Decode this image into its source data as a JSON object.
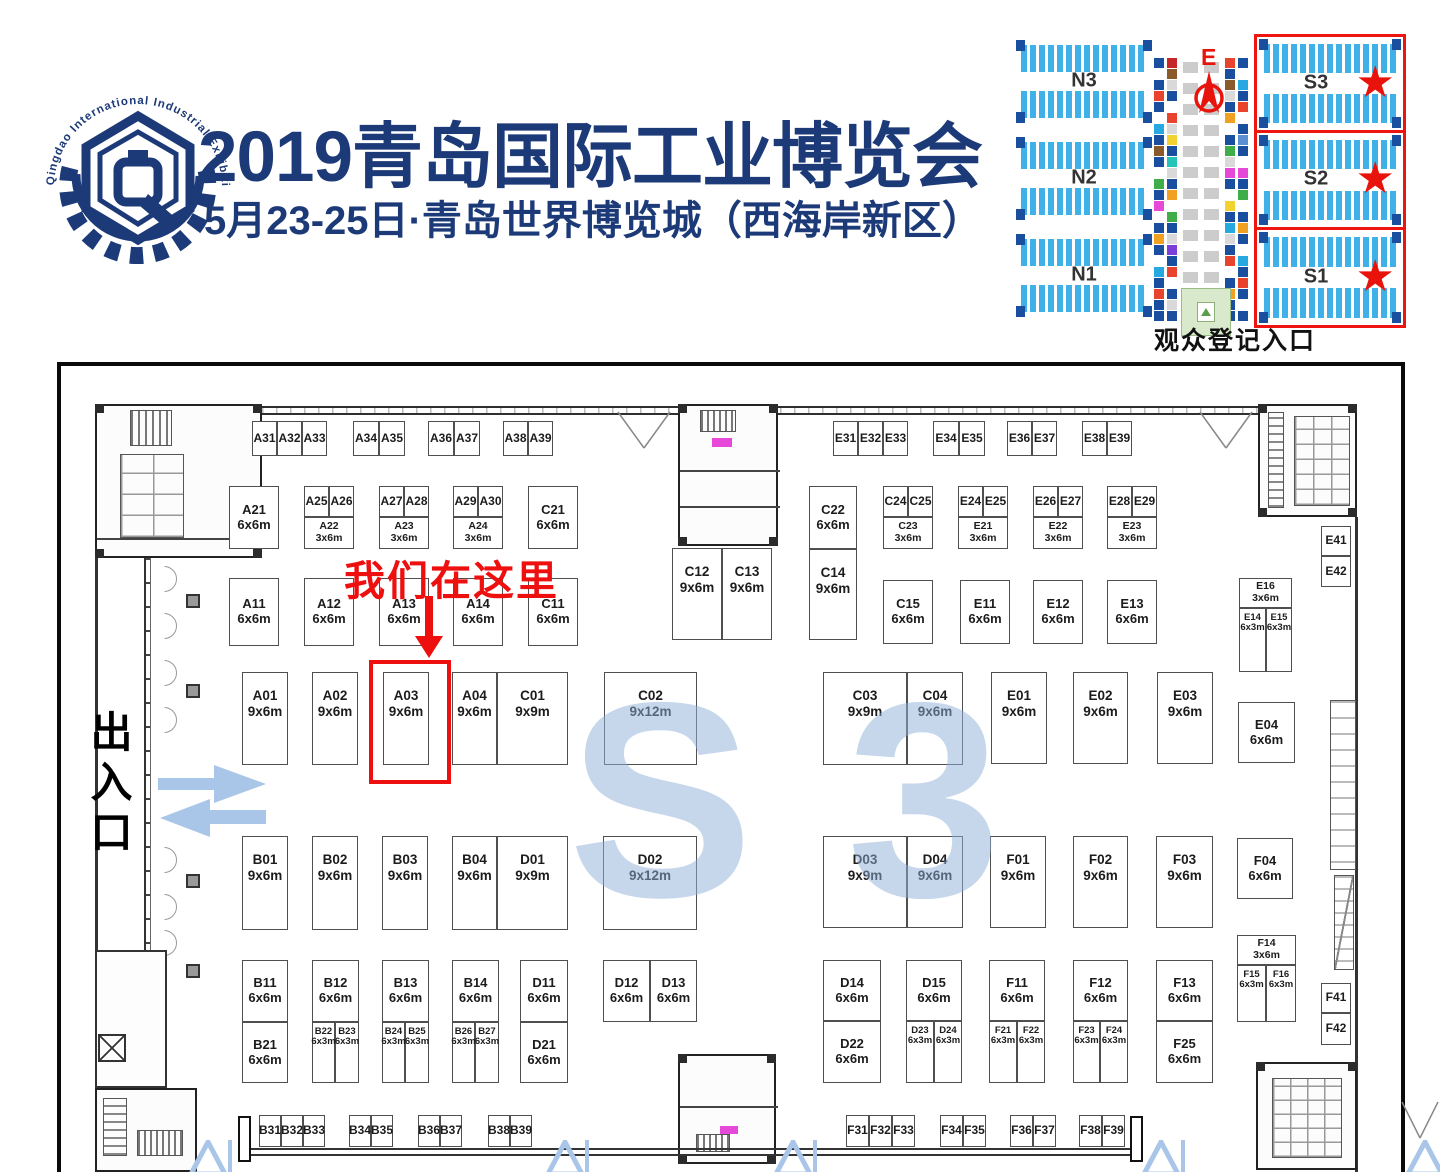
{
  "header": {
    "logo_ring_text": "Qingdao International Industrial Exhibition",
    "title": "2019青岛国际工业博览会",
    "subtitle": "5月23-25日·青岛世界博览城（西海岸新区）"
  },
  "colors": {
    "navy": "#1d3a78",
    "annotation_red": "#ee0f0f",
    "hall_blue": "#3fb0e8",
    "hall_navy": "#1a4fa0",
    "watermark_blue": "#8fb0da",
    "arrow_blue": "#a9c6e8",
    "entrance_green": "#d9e9cc"
  },
  "minimap": {
    "caption": "观众登记入口",
    "compass_label": "E",
    "star_icon": "★",
    "north_halls": [
      {
        "label": "N3",
        "top": 18
      },
      {
        "label": "N2",
        "top": 115
      },
      {
        "label": "N1",
        "top": 212
      }
    ],
    "south_halls": [
      {
        "label": "S3",
        "top": 12,
        "h": 93
      },
      {
        "label": "S2",
        "top": 108,
        "h": 94
      },
      {
        "label": "S1",
        "top": 205,
        "h": 95
      }
    ],
    "corridor_strips": [
      {
        "x": 149,
        "colors": [
          "#1a4fa0",
          "#ffffff",
          "#1a4fa0",
          "#e8432d",
          "#1a4fa0",
          "#ffffff",
          "#26a9e0",
          "#1a4fa0",
          "#8a5a2b",
          "#1a4fa0",
          "#ffffff",
          "#3fae49",
          "#1a4fa0",
          "#e649d8",
          "#ffffff",
          "#1a4fa0",
          "#f0a122",
          "#1a4fa0",
          "#ffffff",
          "#26a9e0",
          "#1a4fa0",
          "#e8432d",
          "#1a4fa0",
          "#1a4fa0"
        ]
      },
      {
        "x": 162,
        "colors": [
          "#c62828",
          "#8a5a2b",
          "#d9d9d9",
          "#1a4fa0",
          "#ffffff",
          "#e8432d",
          "#d9d9d9",
          "#f2d22e",
          "#1a4fa0",
          "#26c4b8",
          "#d9d9d9",
          "#1a4fa0",
          "#f0a122",
          "#ffffff",
          "#3fae49",
          "#1a4fa0",
          "#d9d9d9",
          "#7a3fd8",
          "#1a4fa0",
          "#e8432d",
          "#ffffff",
          "#1a4fa0",
          "#d9d9d9",
          "#1a4fa0"
        ]
      },
      {
        "x": 220,
        "colors": [
          "#e8432d",
          "#1a4fa0",
          "#8a5a2b",
          "#d9d9d9",
          "#1a4fa0",
          "#f0a122",
          "#ffffff",
          "#1a4fa0",
          "#3fae49",
          "#d9d9d9",
          "#e649d8",
          "#1a4fa0",
          "#ffffff",
          "#f2d22e",
          "#1a4fa0",
          "#26a9e0",
          "#d9d9d9",
          "#1a4fa0",
          "#e8432d",
          "#ffffff",
          "#1a4fa0",
          "#f0a122",
          "#1a4fa0",
          "#1a4fa0"
        ]
      },
      {
        "x": 233,
        "colors": [
          "#1a4fa0",
          "#ffffff",
          "#26a9e0",
          "#1a4fa0",
          "#e8432d",
          "#ffffff",
          "#1a4fa0",
          "#5a8fd4",
          "#1a4fa0",
          "#ffffff",
          "#e649d8",
          "#1a4fa0",
          "#3fae49",
          "#ffffff",
          "#1a4fa0",
          "#f0a122",
          "#1a4fa0",
          "#ffffff",
          "#26a9e0",
          "#1a4fa0",
          "#e8432d",
          "#1a4fa0",
          "#ffffff",
          "#1a4fa0"
        ]
      }
    ]
  },
  "floorplan": {
    "watermark": "S 3",
    "exit_label": "出入口",
    "annotation": {
      "text": "我们在这里",
      "target_booth": "A03"
    },
    "booths": [
      {
        "id": "A31",
        "x": 252,
        "y": 421,
        "w": 25,
        "h": 35
      },
      {
        "id": "A32",
        "x": 277,
        "y": 421,
        "w": 25,
        "h": 35
      },
      {
        "id": "A33",
        "x": 302,
        "y": 421,
        "w": 25,
        "h": 35
      },
      {
        "id": "A34",
        "x": 353,
        "y": 421,
        "w": 26,
        "h": 35
      },
      {
        "id": "A35",
        "x": 379,
        "y": 421,
        "w": 26,
        "h": 35
      },
      {
        "id": "A36",
        "x": 428,
        "y": 421,
        "w": 26,
        "h": 35
      },
      {
        "id": "A37",
        "x": 454,
        "y": 421,
        "w": 26,
        "h": 35
      },
      {
        "id": "A38",
        "x": 503,
        "y": 421,
        "w": 25,
        "h": 35
      },
      {
        "id": "A39",
        "x": 528,
        "y": 421,
        "w": 25,
        "h": 35
      },
      {
        "id": "E31",
        "x": 833,
        "y": 421,
        "w": 25,
        "h": 35
      },
      {
        "id": "E32",
        "x": 858,
        "y": 421,
        "w": 25,
        "h": 35
      },
      {
        "id": "E33",
        "x": 883,
        "y": 421,
        "w": 25,
        "h": 35
      },
      {
        "id": "E34",
        "x": 933,
        "y": 421,
        "w": 26,
        "h": 35
      },
      {
        "id": "E35",
        "x": 959,
        "y": 421,
        "w": 26,
        "h": 35
      },
      {
        "id": "E36",
        "x": 1007,
        "y": 421,
        "w": 25,
        "h": 35
      },
      {
        "id": "E37",
        "x": 1032,
        "y": 421,
        "w": 25,
        "h": 35
      },
      {
        "id": "E38",
        "x": 1082,
        "y": 421,
        "w": 25,
        "h": 35
      },
      {
        "id": "E39",
        "x": 1107,
        "y": 421,
        "w": 25,
        "h": 35
      },
      {
        "id": "A21",
        "size": "6x6m",
        "x": 229,
        "y": 486,
        "w": 50,
        "h": 63
      },
      {
        "id": "A25",
        "x": 304,
        "y": 486,
        "w": 25,
        "h": 31
      },
      {
        "id": "A26",
        "x": 329,
        "y": 486,
        "w": 25,
        "h": 31
      },
      {
        "id": "A22",
        "size": "3x6m",
        "x": 304,
        "y": 517,
        "w": 50,
        "h": 32
      },
      {
        "id": "A27",
        "x": 379,
        "y": 486,
        "w": 25,
        "h": 31
      },
      {
        "id": "A28",
        "x": 404,
        "y": 486,
        "w": 25,
        "h": 31
      },
      {
        "id": "A23",
        "size": "3x6m",
        "x": 379,
        "y": 517,
        "w": 50,
        "h": 32
      },
      {
        "id": "A29",
        "x": 453,
        "y": 486,
        "w": 25,
        "h": 31
      },
      {
        "id": "A30",
        "x": 478,
        "y": 486,
        "w": 25,
        "h": 31
      },
      {
        "id": "A24",
        "size": "3x6m",
        "x": 453,
        "y": 517,
        "w": 50,
        "h": 32
      },
      {
        "id": "C21",
        "size": "6x6m",
        "x": 528,
        "y": 486,
        "w": 50,
        "h": 63
      },
      {
        "id": "C22",
        "size": "6x6m",
        "x": 809,
        "y": 486,
        "w": 48,
        "h": 63
      },
      {
        "id": "C24",
        "x": 883,
        "y": 486,
        "w": 25,
        "h": 31
      },
      {
        "id": "C25",
        "x": 908,
        "y": 486,
        "w": 25,
        "h": 31
      },
      {
        "id": "C23",
        "size": "3x6m",
        "x": 883,
        "y": 517,
        "w": 50,
        "h": 32
      },
      {
        "id": "E24",
        "x": 958,
        "y": 486,
        "w": 25,
        "h": 31
      },
      {
        "id": "E25",
        "x": 983,
        "y": 486,
        "w": 25,
        "h": 31
      },
      {
        "id": "E21",
        "size": "3x6m",
        "x": 958,
        "y": 517,
        "w": 50,
        "h": 32
      },
      {
        "id": "E26",
        "x": 1033,
        "y": 486,
        "w": 25,
        "h": 31
      },
      {
        "id": "E27",
        "x": 1058,
        "y": 486,
        "w": 25,
        "h": 31
      },
      {
        "id": "E22",
        "size": "3x6m",
        "x": 1033,
        "y": 517,
        "w": 50,
        "h": 32
      },
      {
        "id": "E28",
        "x": 1107,
        "y": 486,
        "w": 25,
        "h": 31
      },
      {
        "id": "E29",
        "x": 1132,
        "y": 486,
        "w": 25,
        "h": 31
      },
      {
        "id": "E23",
        "size": "3x6m",
        "x": 1107,
        "y": 517,
        "w": 50,
        "h": 32
      },
      {
        "id": "C12",
        "size": "9x6m",
        "x": 672,
        "y": 548,
        "w": 50,
        "h": 92
      },
      {
        "id": "C13",
        "size": "9x6m",
        "x": 722,
        "y": 548,
        "w": 50,
        "h": 92
      },
      {
        "id": "C14",
        "size": "9x6m",
        "x": 809,
        "y": 549,
        "w": 48,
        "h": 91
      },
      {
        "id": "A11",
        "size": "6x6m",
        "x": 229,
        "y": 578,
        "w": 50,
        "h": 68
      },
      {
        "id": "A12",
        "size": "6x6m",
        "x": 304,
        "y": 578,
        "w": 50,
        "h": 68
      },
      {
        "id": "A13",
        "size": "6x6m",
        "x": 379,
        "y": 578,
        "w": 50,
        "h": 68
      },
      {
        "id": "A14",
        "size": "6x6m",
        "x": 453,
        "y": 578,
        "w": 50,
        "h": 68
      },
      {
        "id": "C11",
        "size": "6x6m",
        "x": 528,
        "y": 578,
        "w": 50,
        "h": 68
      },
      {
        "id": "C15",
        "size": "6x6m",
        "x": 883,
        "y": 580,
        "w": 50,
        "h": 64
      },
      {
        "id": "E11",
        "size": "6x6m",
        "x": 960,
        "y": 580,
        "w": 50,
        "h": 64
      },
      {
        "id": "E12",
        "size": "6x6m",
        "x": 1033,
        "y": 580,
        "w": 50,
        "h": 64
      },
      {
        "id": "E13",
        "size": "6x6m",
        "x": 1107,
        "y": 580,
        "w": 50,
        "h": 64
      },
      {
        "id": "E41",
        "x": 1321,
        "y": 526,
        "w": 30,
        "h": 30
      },
      {
        "id": "E42",
        "x": 1321,
        "y": 556,
        "w": 30,
        "h": 31
      },
      {
        "id": "E16",
        "size": "3x6m",
        "x": 1239,
        "y": 578,
        "w": 53,
        "h": 30
      },
      {
        "id": "E14",
        "size": "6x3m",
        "x": 1239,
        "y": 608,
        "w": 27,
        "h": 64
      },
      {
        "id": "E15",
        "size": "6x3m",
        "x": 1266,
        "y": 608,
        "w": 26,
        "h": 64
      },
      {
        "id": "E04",
        "size": "6x6m",
        "x": 1238,
        "y": 702,
        "w": 57,
        "h": 61
      },
      {
        "id": "A01",
        "size": "9x6m",
        "x": 242,
        "y": 672,
        "w": 46,
        "h": 93
      },
      {
        "id": "A02",
        "size": "9x6m",
        "x": 312,
        "y": 672,
        "w": 46,
        "h": 93
      },
      {
        "id": "A03",
        "size": "9x6m",
        "x": 383,
        "y": 672,
        "w": 46,
        "h": 93
      },
      {
        "id": "A04",
        "size": "9x6m",
        "x": 452,
        "y": 672,
        "w": 45,
        "h": 93
      },
      {
        "id": "C01",
        "size": "9x9m",
        "x": 497,
        "y": 672,
        "w": 71,
        "h": 93
      },
      {
        "id": "C02",
        "size": "9x12m",
        "x": 604,
        "y": 672,
        "w": 93,
        "h": 93
      },
      {
        "id": "C03",
        "size": "9x9m",
        "x": 823,
        "y": 672,
        "w": 84,
        "h": 93
      },
      {
        "id": "C04",
        "size": "9x6m",
        "x": 907,
        "y": 672,
        "w": 56,
        "h": 93
      },
      {
        "id": "E01",
        "size": "9x6m",
        "x": 991,
        "y": 672,
        "w": 56,
        "h": 92
      },
      {
        "id": "E02",
        "size": "9x6m",
        "x": 1073,
        "y": 672,
        "w": 55,
        "h": 92
      },
      {
        "id": "E03",
        "size": "9x6m",
        "x": 1157,
        "y": 672,
        "w": 56,
        "h": 92
      },
      {
        "id": "B01",
        "size": "9x6m",
        "x": 242,
        "y": 836,
        "w": 46,
        "h": 94
      },
      {
        "id": "B02",
        "size": "9x6m",
        "x": 312,
        "y": 836,
        "w": 46,
        "h": 94
      },
      {
        "id": "B03",
        "size": "9x6m",
        "x": 382,
        "y": 836,
        "w": 46,
        "h": 94
      },
      {
        "id": "B04",
        "size": "9x6m",
        "x": 452,
        "y": 836,
        "w": 45,
        "h": 94
      },
      {
        "id": "D01",
        "size": "9x9m",
        "x": 497,
        "y": 836,
        "w": 71,
        "h": 94
      },
      {
        "id": "D02",
        "size": "9x12m",
        "x": 603,
        "y": 836,
        "w": 94,
        "h": 94
      },
      {
        "id": "D03",
        "size": "9x9m",
        "x": 823,
        "y": 836,
        "w": 84,
        "h": 92
      },
      {
        "id": "D04",
        "size": "9x6m",
        "x": 907,
        "y": 836,
        "w": 56,
        "h": 92
      },
      {
        "id": "F01",
        "size": "9x6m",
        "x": 990,
        "y": 836,
        "w": 56,
        "h": 92
      },
      {
        "id": "F02",
        "size": "9x6m",
        "x": 1073,
        "y": 836,
        "w": 55,
        "h": 92
      },
      {
        "id": "F03",
        "size": "9x6m",
        "x": 1156,
        "y": 836,
        "w": 57,
        "h": 92
      },
      {
        "id": "F04",
        "size": "6x6m",
        "x": 1237,
        "y": 838,
        "w": 56,
        "h": 61
      },
      {
        "id": "B11",
        "size": "6x6m",
        "x": 242,
        "y": 960,
        "w": 46,
        "h": 62
      },
      {
        "id": "B21",
        "size": "6x6m",
        "x": 242,
        "y": 1022,
        "w": 46,
        "h": 61
      },
      {
        "id": "B12",
        "size": "6x6m",
        "x": 312,
        "y": 960,
        "w": 47,
        "h": 62
      },
      {
        "id": "B22",
        "size": "6x3m",
        "x": 312,
        "y": 1022,
        "w": 23,
        "h": 61
      },
      {
        "id": "B23",
        "size": "6x3m",
        "x": 335,
        "y": 1022,
        "w": 24,
        "h": 61
      },
      {
        "id": "B13",
        "size": "6x6m",
        "x": 382,
        "y": 960,
        "w": 47,
        "h": 62
      },
      {
        "id": "B24",
        "size": "6x3m",
        "x": 382,
        "y": 1022,
        "w": 23,
        "h": 61
      },
      {
        "id": "B25",
        "size": "6x3m",
        "x": 405,
        "y": 1022,
        "w": 24,
        "h": 61
      },
      {
        "id": "B14",
        "size": "6x6m",
        "x": 452,
        "y": 960,
        "w": 47,
        "h": 62
      },
      {
        "id": "B26",
        "size": "6x3m",
        "x": 452,
        "y": 1022,
        "w": 23,
        "h": 61
      },
      {
        "id": "B27",
        "size": "6x3m",
        "x": 475,
        "y": 1022,
        "w": 24,
        "h": 61
      },
      {
        "id": "D11",
        "size": "6x6m",
        "x": 520,
        "y": 960,
        "w": 48,
        "h": 62
      },
      {
        "id": "D21",
        "size": "6x6m",
        "x": 520,
        "y": 1022,
        "w": 48,
        "h": 61
      },
      {
        "id": "D12",
        "size": "6x6m",
        "x": 603,
        "y": 960,
        "w": 47,
        "h": 62
      },
      {
        "id": "D13",
        "size": "6x6m",
        "x": 650,
        "y": 960,
        "w": 47,
        "h": 62
      },
      {
        "id": "D14",
        "size": "6x6m",
        "x": 823,
        "y": 960,
        "w": 58,
        "h": 61
      },
      {
        "id": "D22",
        "size": "6x6m",
        "x": 823,
        "y": 1021,
        "w": 58,
        "h": 62
      },
      {
        "id": "D15",
        "size": "6x6m",
        "x": 906,
        "y": 960,
        "w": 56,
        "h": 61
      },
      {
        "id": "D23",
        "size": "6x3m",
        "x": 906,
        "y": 1021,
        "w": 28,
        "h": 62
      },
      {
        "id": "D24",
        "size": "6x3m",
        "x": 934,
        "y": 1021,
        "w": 28,
        "h": 62
      },
      {
        "id": "F11",
        "size": "6x6m",
        "x": 989,
        "y": 960,
        "w": 56,
        "h": 61
      },
      {
        "id": "F21",
        "size": "6x3m",
        "x": 989,
        "y": 1021,
        "w": 28,
        "h": 62
      },
      {
        "id": "F22",
        "size": "6x3m",
        "x": 1017,
        "y": 1021,
        "w": 28,
        "h": 62
      },
      {
        "id": "F12",
        "size": "6x6m",
        "x": 1073,
        "y": 960,
        "w": 55,
        "h": 61
      },
      {
        "id": "F23",
        "size": "6x3m",
        "x": 1073,
        "y": 1021,
        "w": 27,
        "h": 62
      },
      {
        "id": "F24",
        "size": "6x3m",
        "x": 1100,
        "y": 1021,
        "w": 28,
        "h": 62
      },
      {
        "id": "F13",
        "size": "6x6m",
        "x": 1156,
        "y": 960,
        "w": 57,
        "h": 61
      },
      {
        "id": "F25",
        "size": "6x6m",
        "x": 1156,
        "y": 1021,
        "w": 57,
        "h": 62
      },
      {
        "id": "F14",
        "size": "3x6m",
        "x": 1237,
        "y": 935,
        "w": 59,
        "h": 30
      },
      {
        "id": "F15",
        "size": "6x3m",
        "x": 1237,
        "y": 965,
        "w": 29,
        "h": 57
      },
      {
        "id": "F16",
        "size": "6x3m",
        "x": 1266,
        "y": 965,
        "w": 30,
        "h": 57
      },
      {
        "id": "F41",
        "x": 1321,
        "y": 983,
        "w": 30,
        "h": 30
      },
      {
        "id": "F42",
        "x": 1321,
        "y": 1013,
        "w": 30,
        "h": 32
      },
      {
        "id": "B31",
        "x": 259,
        "y": 1115,
        "w": 22,
        "h": 32
      },
      {
        "id": "B32",
        "x": 281,
        "y": 1115,
        "w": 22,
        "h": 32
      },
      {
        "id": "B33",
        "x": 303,
        "y": 1115,
        "w": 22,
        "h": 32
      },
      {
        "id": "B34",
        "x": 349,
        "y": 1115,
        "w": 22,
        "h": 32
      },
      {
        "id": "B35",
        "x": 371,
        "y": 1115,
        "w": 22,
        "h": 32
      },
      {
        "id": "B36",
        "x": 418,
        "y": 1115,
        "w": 22,
        "h": 32
      },
      {
        "id": "B37",
        "x": 440,
        "y": 1115,
        "w": 22,
        "h": 32
      },
      {
        "id": "B38",
        "x": 488,
        "y": 1115,
        "w": 22,
        "h": 32
      },
      {
        "id": "B39",
        "x": 510,
        "y": 1115,
        "w": 22,
        "h": 32
      },
      {
        "id": "F31",
        "x": 846,
        "y": 1115,
        "w": 23,
        "h": 32
      },
      {
        "id": "F32",
        "x": 869,
        "y": 1115,
        "w": 23,
        "h": 32
      },
      {
        "id": "F33",
        "x": 892,
        "y": 1115,
        "w": 23,
        "h": 32
      },
      {
        "id": "F34",
        "x": 940,
        "y": 1115,
        "w": 23,
        "h": 32
      },
      {
        "id": "F35",
        "x": 963,
        "y": 1115,
        "w": 23,
        "h": 32
      },
      {
        "id": "F36",
        "x": 1010,
        "y": 1115,
        "w": 23,
        "h": 32
      },
      {
        "id": "F37",
        "x": 1033,
        "y": 1115,
        "w": 23,
        "h": 32
      },
      {
        "id": "F38",
        "x": 1079,
        "y": 1115,
        "w": 23,
        "h": 32
      },
      {
        "id": "F39",
        "x": 1102,
        "y": 1115,
        "w": 23,
        "h": 32
      }
    ]
  }
}
